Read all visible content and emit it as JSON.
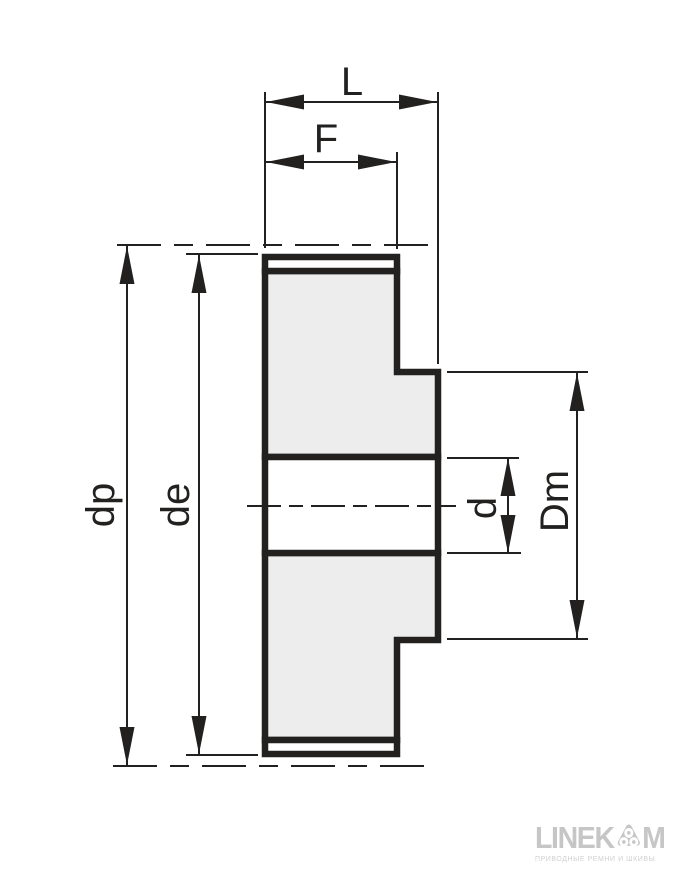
{
  "diagram": {
    "title": "timing-pulley-cross-section-dimension-drawing",
    "labels": {
      "L": "L",
      "F": "F",
      "dp": "dp",
      "de": "de",
      "d": "d",
      "Dm": "Dm"
    },
    "dimension_meanings": {
      "L": "overall width with hub",
      "F": "belt face width",
      "dp": "pitch diameter",
      "de": "outside diameter",
      "d": "bore diameter",
      "Dm": "hub diameter"
    }
  },
  "logo": {
    "brand_pre": "LINEK",
    "brand_post": "M",
    "icon": "pulley-triangle-with-three-rollers",
    "tagline": "ПРИВОДНЫЕ РЕМНИ И ШКИВЫ"
  },
  "colors": {
    "line": "#222120",
    "part-fill": "#ededed",
    "logo-gray": "#c6c6c6",
    "logo-light": "#d0d0d0"
  }
}
